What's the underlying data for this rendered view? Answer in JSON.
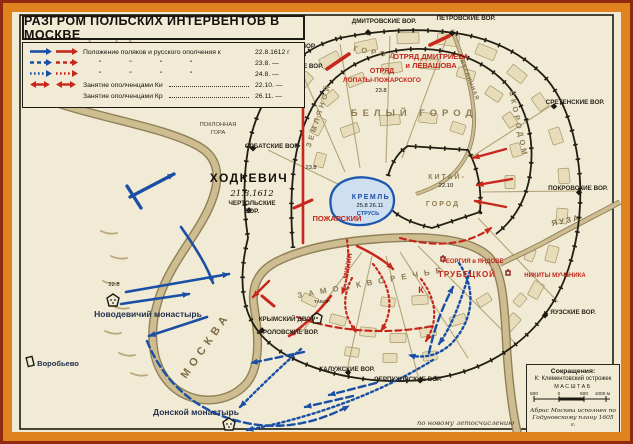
{
  "title": "РАЗГРОМ ПОЛЬСКИХ ИНТЕРВЕНТОВ В МОСКВЕ",
  "colors": {
    "polish_blue": "#1a4fa6",
    "militia_red": "#c8271c",
    "frame_orange": "#e0831f",
    "map_cream": "#f1ebd5",
    "river_tan": "#cdbd90"
  },
  "legend": {
    "rows": [
      {
        "style": "solid",
        "label": "Положение поляков и русского ополчения к",
        "date": "22.8.1612 г"
      },
      {
        "style": "dashed",
        "label": "\"        \"        \"        \"",
        "date": "23.8. —"
      },
      {
        "style": "dotted",
        "label": "\"        \"        \"        \"",
        "date": "24.8. —"
      },
      {
        "style": "red-double",
        "label": "Занятие ополченцами Китай-города",
        "date": "22.10. —"
      },
      {
        "style": "none",
        "label": "Занятие ополченцами Кремля",
        "date": "26.11. —"
      }
    ]
  },
  "map": {
    "districts": {
      "bely": "БЕЛЫЙ ГОРОД",
      "zemlyanoy": "ЗЕМЛЯНОЙ",
      "gorod": "ГОРОД",
      "skorodom": "СКОРОДОМ",
      "kitay_line1": "КИТАЙ-",
      "kitay_line2": "ГОРОД",
      "kremlin": "КРЕМЛЬ",
      "zamoskvorechye": "ЗАМОСКВОРЕЧЬЕ"
    },
    "gates": {
      "dmitrovskie": "ДМИТРОВСКИЕ ВОР.",
      "petrovskie": "ПЕТРОВСКИЕ ВОР.",
      "tverskie": "ТВЕРСКИЕ ВОР.",
      "nikitskie": "НИКИТСКИЕ ВОР.",
      "orbatskie": "ОРБАТСКИЕ ВОР.",
      "sretenskie": "СРЕТЕНСКИЕ ВОР.",
      "pokrovskie": "ПОКРОВСКИЕ ВОР.",
      "yauzskie": "ЯУЗСКИЕ ВОР.",
      "chertolskie_1": "ЧЕРТОЛЬСКИЕ",
      "chertolskie_2": "ВОР.",
      "frolovskie": "ФРОЛОВСКИЕ ВОР.",
      "kaluzhskie": "КАЛУЖСКИЕ ВОР.",
      "serpukhovskie": "СЕРПУХОВСКИЕ ВОР.",
      "krymsky": "КРЫМСКИЙ ДВОР"
    },
    "rivers": {
      "moskva": "МОСКВА",
      "yauza": "ЯУЗА",
      "neglinnaya": "НЕГЛИННАЯ"
    },
    "forces": {
      "khodkevich": "ХОДКЕВИЧ",
      "khodkevich_date": "21.8.1612",
      "otryad_dmitrieva_1": "ОТРЯД ДМИТРИЕВА",
      "otryad_dmitrieva_2": "и ЛЕВАШОВА",
      "otryad_lopaty_1": "ОТРЯД",
      "otryad_lopaty_2": "ЛОПАТЫ-ПОЖАРСКОГО",
      "pozharsky": "ПОЖАРСКИЙ",
      "minin": "МИНИН",
      "trubetskoy": "ТРУБЕЦКОЙ",
      "strus": "СТРУСЬ",
      "tabor": "ТАБОР",
      "ostrozhek_mark": "К"
    },
    "places": {
      "poklonnaya_1": "ПОКЛОННАЯ",
      "poklonnaya_2": "ГОРА",
      "novodevichy": "Новодевичий монастырь",
      "donskoy": "Донской монастырь",
      "vorobyovo": "Воробьево",
      "georgiya": "ГЕОРГИЯ в ЯНДОВЕ",
      "nikity": "НИКИТЫ МУЧЕНИКА"
    },
    "dates": {
      "d22_8": "22.8",
      "d23_8_west": "23.8",
      "d23_8_north": "23.8",
      "kremlin_dates": "25.8  26.11",
      "kitay_date": "22.10"
    }
  },
  "scalebox": {
    "abbrev_title": "Сокращения:",
    "abbrev_line": "К: Клементовский острожек",
    "scale_title": "МАСШТАБ",
    "ticks": [
      "500",
      "0",
      "500",
      "1000 м"
    ],
    "credit_1": "Абрис Москвы исполнен по",
    "credit_2": "Годуновскому плану 1605 г."
  },
  "note": "по новому летосчислению"
}
